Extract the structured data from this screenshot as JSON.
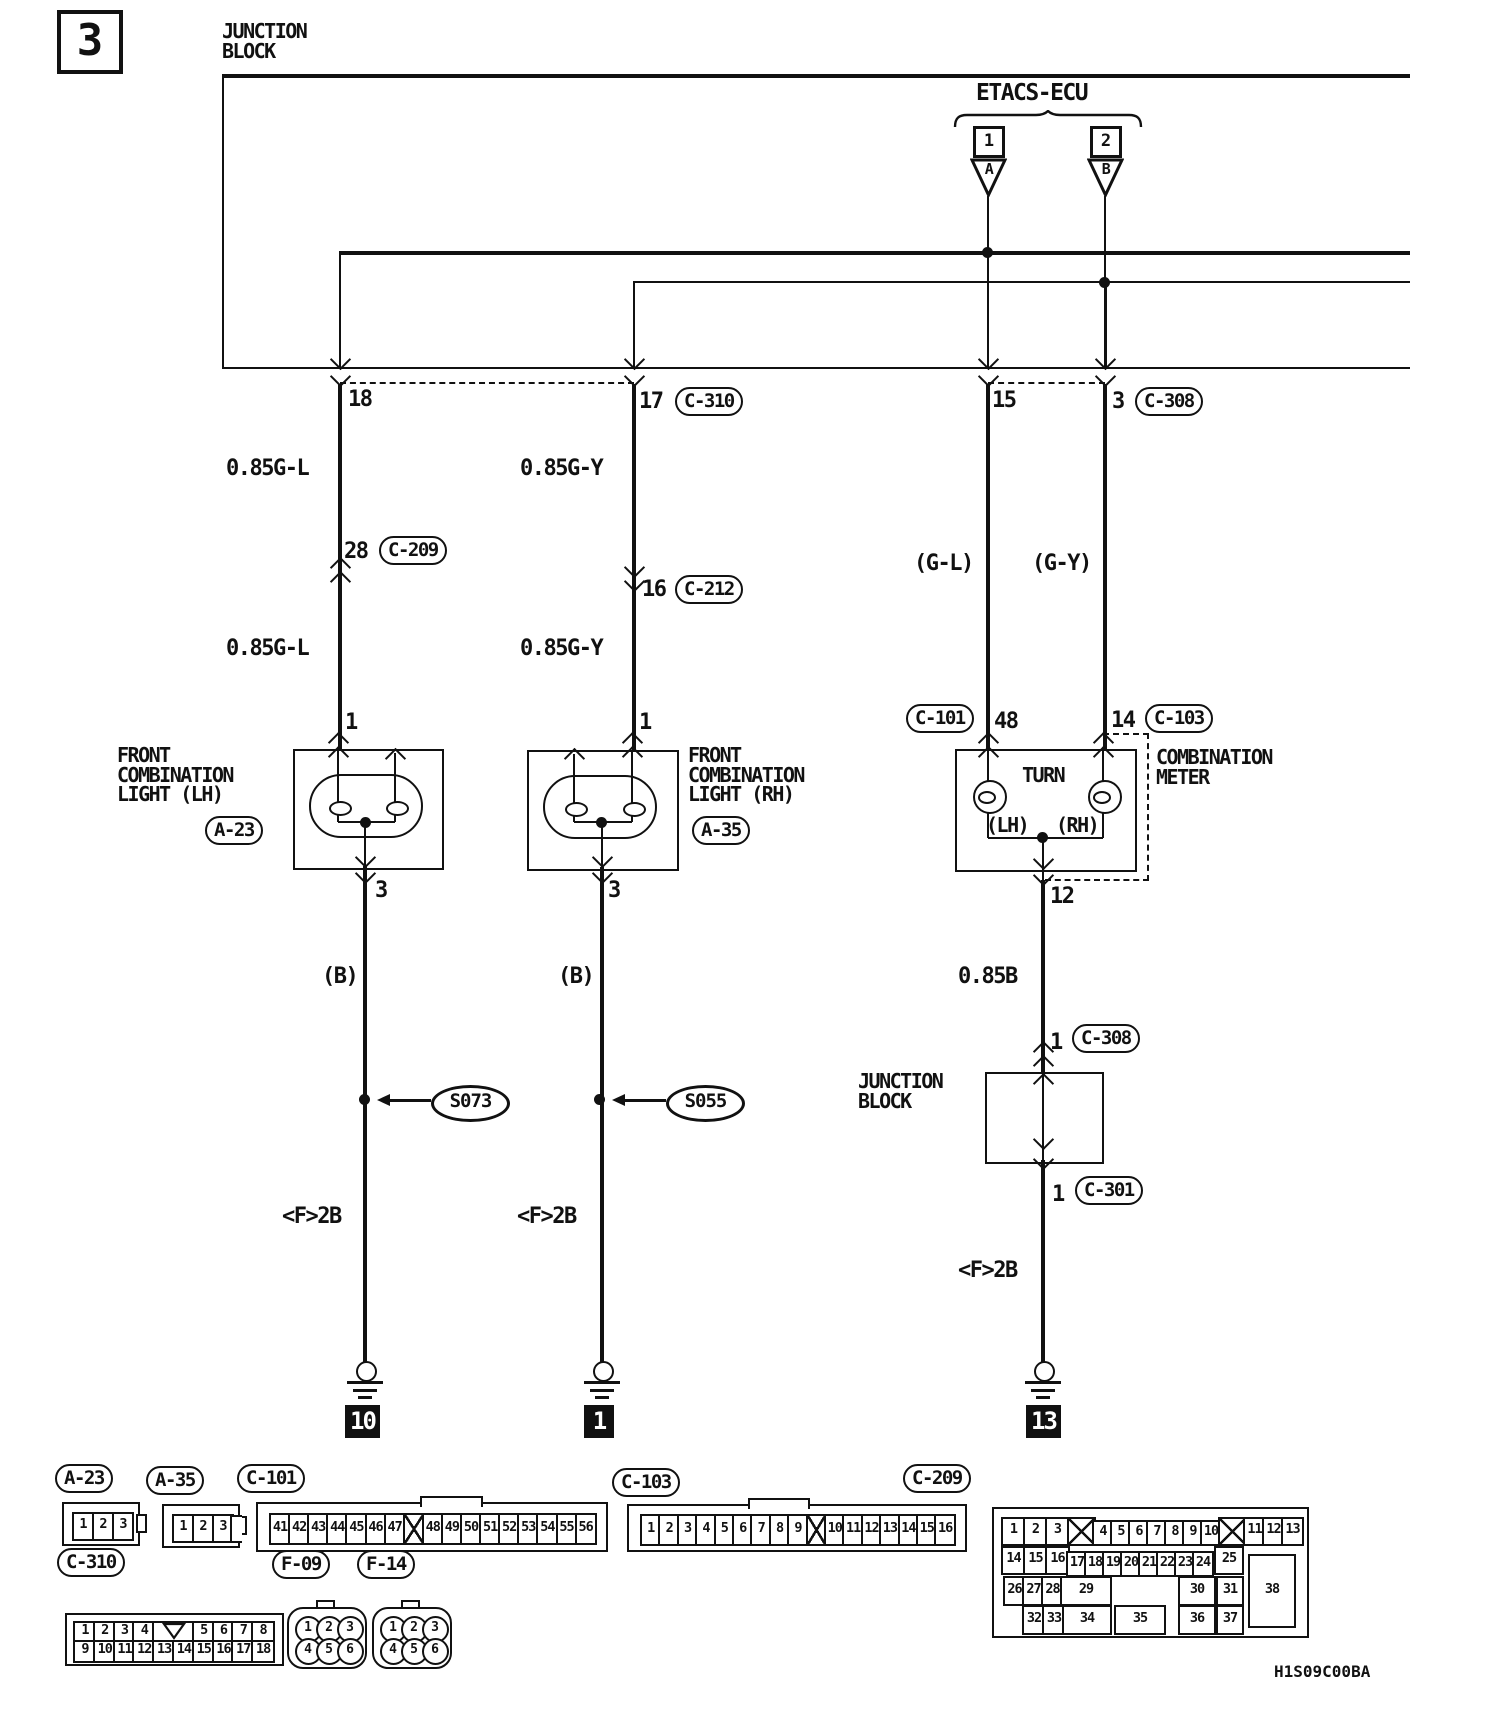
{
  "t": {
    "sheet": "3",
    "jb_line1": "JUNCTION",
    "jb_line2": "BLOCK",
    "etacs": "ETACS-ECU",
    "e1": "1",
    "e2": "2",
    "ea": "A",
    "eb": "B",
    "p18": "18",
    "p17": "17",
    "c310": "C-310",
    "p15": "15",
    "p3": "3",
    "c308": "C-308",
    "gl1": "0.85G-L",
    "gy1": "0.85G-Y",
    "p28": "28",
    "c209": "C-209",
    "p16": "16",
    "c212": "C-212",
    "gl2": "0.85G-L",
    "gy2": "0.85G-Y",
    "glp": "(G-L)",
    "gyp": "(G-Y)",
    "c101": "C-101",
    "p48": "48",
    "p14": "14",
    "c103": "C-103",
    "front": "FRONT",
    "combination": "COMBINATION",
    "light_lh": "LIGHT (LH)",
    "light_rh": "LIGHT (RH)",
    "a23": "A-23",
    "a35": "A-35",
    "meter": "METER",
    "turn": "TURN",
    "mlh": "(LH)",
    "mrh": "(RH)",
    "pin1": "1",
    "pin3": "3",
    "b": "(B)",
    "s073": "S073",
    "s055": "S055",
    "f2b": "<F>2B",
    "g10": "10",
    "g1": "1",
    "g13": "13",
    "p12": "12",
    "b085": "0.85B",
    "p1": "1",
    "c308b": "C-308",
    "c301": "C-301",
    "code": "H1S09C00BA",
    "f09": "F-09",
    "f14": "F-14"
  },
  "connectors": {
    "a23": {
      "label": "A-23",
      "type": "pins",
      "cells": [
        "1",
        "2",
        "3"
      ],
      "layout": {
        "x0": 8,
        "y": 8,
        "w": 18,
        "step": 20,
        "h": 25
      }
    },
    "a35": {
      "label": "A-35",
      "type": "pins",
      "cells": [
        "1",
        "2",
        "3"
      ],
      "layout": {
        "x0": 8,
        "y": 8,
        "w": 18,
        "step": 20,
        "h": 25
      }
    },
    "c101": {
      "label": "C-101",
      "type": "strip",
      "cells": [
        "41",
        "42",
        "43",
        "44",
        "45",
        "46",
        "47",
        "X",
        "48",
        "49",
        "50",
        "51",
        "52",
        "53",
        "54",
        "55",
        "56"
      ],
      "notch": {
        "start": 8,
        "span": 3
      },
      "layout": {
        "x0": 11,
        "y": 9,
        "w": 18,
        "step": 19.1,
        "h": 28
      }
    },
    "c103": {
      "label": "C-103",
      "type": "strip",
      "cells": [
        "1",
        "2",
        "3",
        "4",
        "5",
        "6",
        "7",
        "8",
        "9",
        "X",
        "10",
        "11",
        "12",
        "13",
        "14",
        "15",
        "16"
      ],
      "notch": {
        "start": 6,
        "span": 3
      },
      "layout": {
        "x0": 11,
        "y": 8,
        "w": 17.5,
        "step": 18.4,
        "h": 28
      }
    },
    "c310": {
      "label": "C-310",
      "type": "grid10",
      "row1": [
        "1",
        "2",
        "3",
        "4",
        "V",
        "5",
        "6",
        "7",
        "8"
      ],
      "row2": [
        "9",
        "10",
        "11",
        "12",
        "13",
        "14",
        "15",
        "16",
        "17",
        "18"
      ],
      "layout": {
        "x0": 6,
        "y0": 6,
        "w": 19.8,
        "h": 19
      }
    },
    "f09": {
      "label": "F-09",
      "type": "circles",
      "cells": [
        "1",
        "2",
        "3",
        "4",
        "5",
        "6"
      ]
    },
    "f14": {
      "label": "F-14",
      "type": "circles",
      "cells": [
        "1",
        "2",
        "3",
        "4",
        "5",
        "6"
      ]
    },
    "c209": {
      "label": "C-209",
      "type": "free",
      "cells": [
        {
          "t": "1",
          "x": 7,
          "y": 8,
          "w": 21,
          "h": 25
        },
        {
          "t": "2",
          "x": 29,
          "y": 8,
          "w": 21,
          "h": 25
        },
        {
          "t": "3",
          "x": 51,
          "y": 8,
          "w": 21,
          "h": 25
        },
        {
          "t": "X",
          "x": 73,
          "y": 8,
          "w": 25,
          "h": 25
        },
        {
          "t": "4",
          "x": 98,
          "y": 11,
          "w": 18,
          "h": 22
        },
        {
          "t": "5",
          "x": 116,
          "y": 11,
          "w": 18,
          "h": 22
        },
        {
          "t": "6",
          "x": 134,
          "y": 11,
          "w": 18,
          "h": 22
        },
        {
          "t": "7",
          "x": 152,
          "y": 11,
          "w": 18,
          "h": 22
        },
        {
          "t": "8",
          "x": 170,
          "y": 11,
          "w": 18,
          "h": 22
        },
        {
          "t": "9",
          "x": 188,
          "y": 11,
          "w": 18,
          "h": 22
        },
        {
          "t": "10",
          "x": 206,
          "y": 11,
          "w": 18,
          "h": 22
        },
        {
          "t": "X",
          "x": 224,
          "y": 8,
          "w": 25,
          "h": 25
        },
        {
          "t": "11",
          "x": 249,
          "y": 8,
          "w": 19,
          "h": 25
        },
        {
          "t": "12",
          "x": 268,
          "y": 8,
          "w": 19,
          "h": 25
        },
        {
          "t": "13",
          "x": 287,
          "y": 8,
          "w": 19,
          "h": 25
        },
        {
          "t": "14",
          "x": 7,
          "y": 37,
          "w": 21,
          "h": 25
        },
        {
          "t": "15",
          "x": 29,
          "y": 37,
          "w": 21,
          "h": 25
        },
        {
          "t": "16",
          "x": 51,
          "y": 37,
          "w": 21,
          "h": 25
        },
        {
          "t": "17",
          "x": 72,
          "y": 42,
          "w": 18,
          "h": 22
        },
        {
          "t": "18",
          "x": 90,
          "y": 42,
          "w": 18,
          "h": 22
        },
        {
          "t": "19",
          "x": 108,
          "y": 42,
          "w": 18,
          "h": 22
        },
        {
          "t": "20",
          "x": 126,
          "y": 42,
          "w": 18,
          "h": 22
        },
        {
          "t": "21",
          "x": 144,
          "y": 42,
          "w": 18,
          "h": 22
        },
        {
          "t": "22",
          "x": 162,
          "y": 42,
          "w": 18,
          "h": 22
        },
        {
          "t": "23",
          "x": 180,
          "y": 42,
          "w": 18,
          "h": 22
        },
        {
          "t": "24",
          "x": 198,
          "y": 42,
          "w": 18,
          "h": 22
        },
        {
          "t": "25",
          "x": 220,
          "y": 37,
          "w": 26,
          "h": 25
        },
        {
          "t": "26",
          "x": 9,
          "y": 67,
          "w": 19,
          "h": 26
        },
        {
          "t": "27",
          "x": 28,
          "y": 67,
          "w": 19,
          "h": 26
        },
        {
          "t": "28",
          "x": 47,
          "y": 67,
          "w": 19,
          "h": 26
        },
        {
          "t": "29",
          "x": 66,
          "y": 67,
          "w": 48,
          "h": 26
        },
        {
          "t": "30",
          "x": 184,
          "y": 67,
          "w": 34,
          "h": 26
        },
        {
          "t": "31",
          "x": 222,
          "y": 67,
          "w": 24,
          "h": 26
        },
        {
          "t": "38",
          "x": 254,
          "y": 45,
          "w": 44,
          "h": 70
        },
        {
          "t": "32",
          "x": 28,
          "y": 96,
          "w": 20,
          "h": 26
        },
        {
          "t": "33",
          "x": 48,
          "y": 96,
          "w": 20,
          "h": 26
        },
        {
          "t": "34",
          "x": 68,
          "y": 96,
          "w": 46,
          "h": 26
        },
        {
          "t": "35",
          "x": 120,
          "y": 96,
          "w": 48,
          "h": 26
        },
        {
          "t": "36",
          "x": 184,
          "y": 96,
          "w": 34,
          "h": 26
        },
        {
          "t": "37",
          "x": 222,
          "y": 96,
          "w": 24,
          "h": 26
        }
      ]
    }
  }
}
